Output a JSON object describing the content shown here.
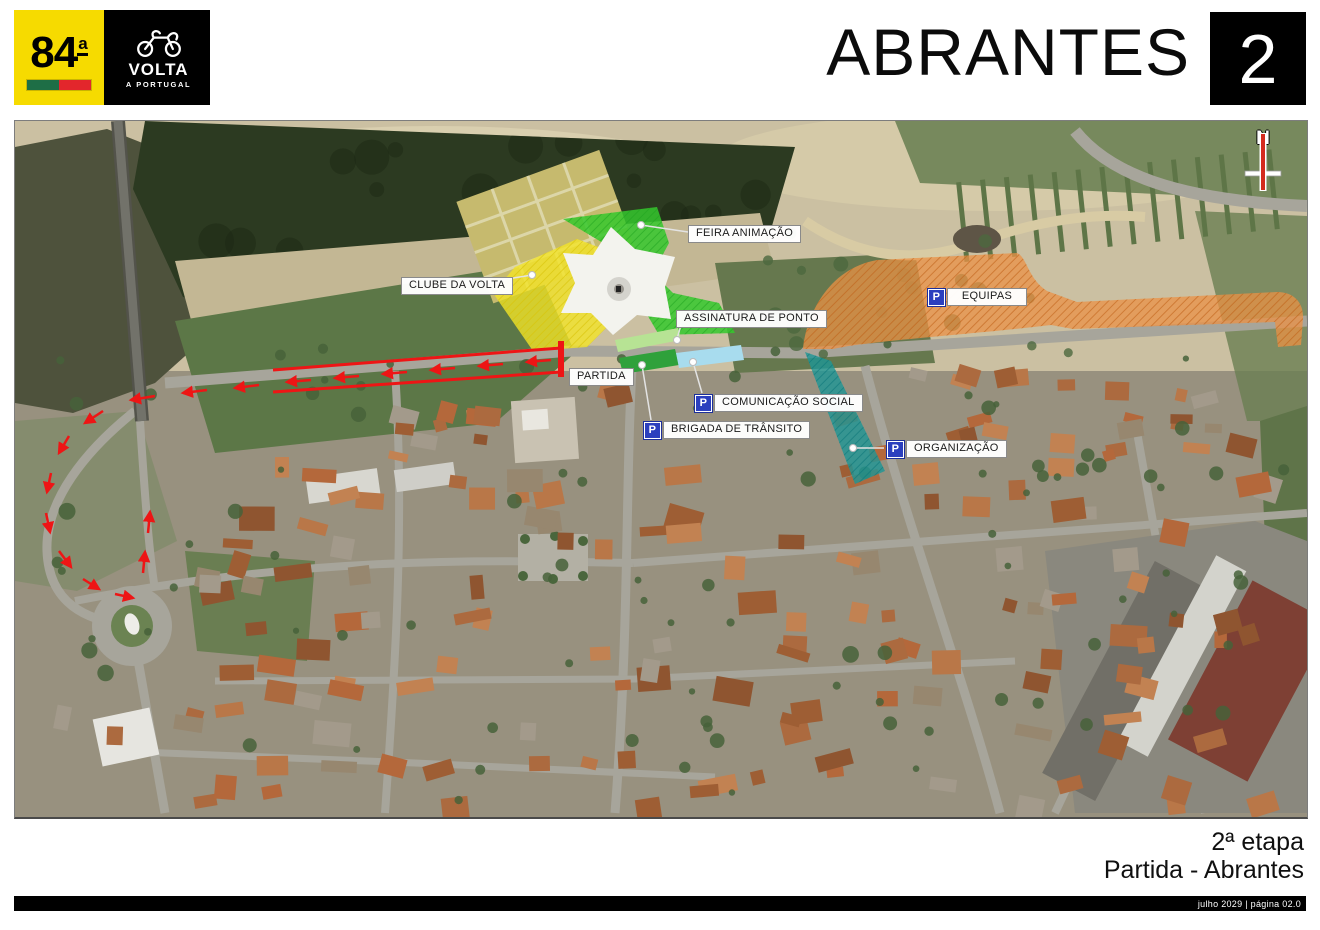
{
  "header": {
    "edition_number": "84",
    "edition_ordinal": "a",
    "logo": {
      "title": "VOLTA",
      "subtitle": "A PORTUGAL"
    },
    "city": "ABRANTES",
    "stage_number": "2"
  },
  "map": {
    "compass": "N",
    "parking_letter": "P",
    "labels": {
      "feira": "FEIRA ANIMAÇÃO",
      "clube": "CLUBE DA VOLTA",
      "assinatura": "ASSINATURA DE PONTO",
      "partida": "PARTIDA",
      "equipas": "EQUIPAS",
      "comunicacao": "COMUNICAÇÃO SOCIAL",
      "brigada": "BRIGADA DE TRÂNSITO",
      "organizacao": "ORGANIZAÇÃO"
    },
    "colors": {
      "route_red": "#EE1515",
      "zone_yellow": "#F2E428",
      "zone_green": "#35C82D",
      "zone_light_green": "#B7E394",
      "zone_dark_green": "#2FA13B",
      "zone_light_blue": "#A8DCEE",
      "zone_orange": "#EB9146",
      "zone_teal": "#1E9696",
      "parking_blue": "#2B3FBE"
    }
  },
  "footer": {
    "stage_label": "2ª etapa",
    "route_label": "Partida - Abrantes",
    "page_info": "julho 2029 | página 02.0"
  }
}
